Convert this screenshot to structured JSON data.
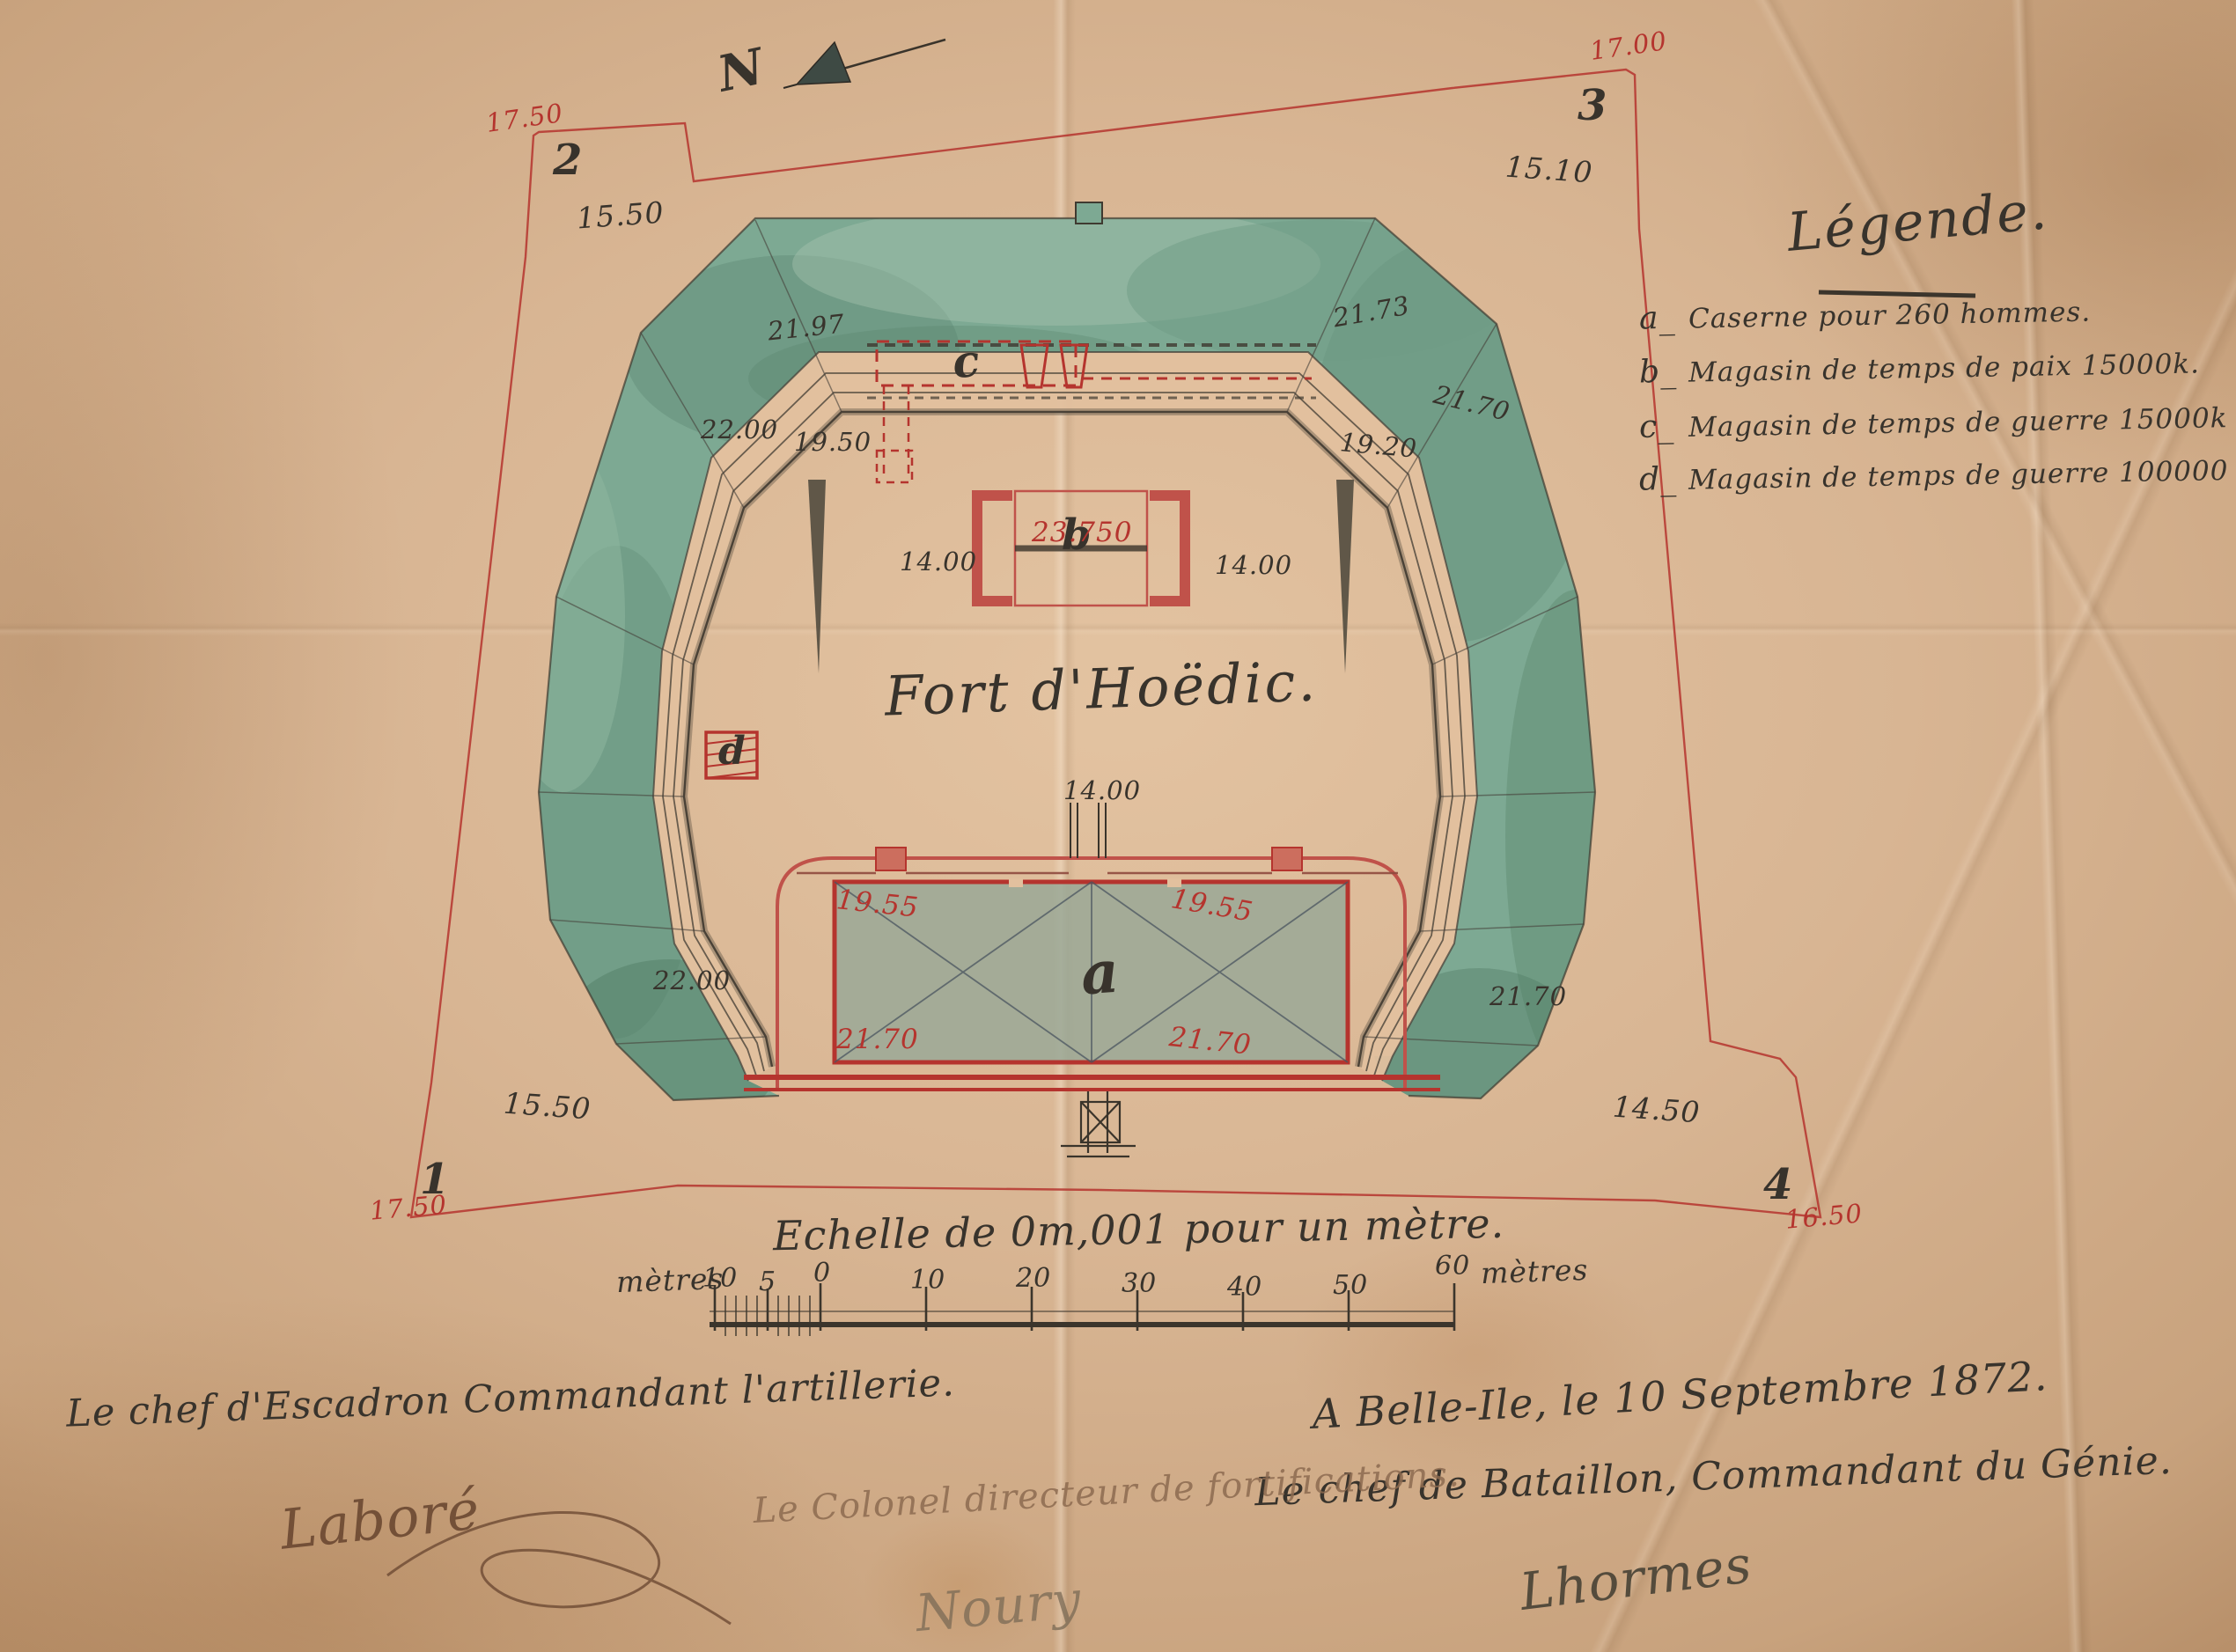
{
  "title": "Fort d'Hoëdic.",
  "north": {
    "label": "N"
  },
  "legend": {
    "header": "Légende.",
    "items": [
      {
        "key": "a_",
        "text": "Caserne pour 260 hommes."
      },
      {
        "key": "b_",
        "text": "Magasin de temps de paix 15000k."
      },
      {
        "key": "c_",
        "text": "Magasin de temps de guerre 15000k"
      },
      {
        "key": "d_",
        "text": "Magasin de temps de guerre 100000 Cartouches."
      }
    ]
  },
  "scale": {
    "caption": "Echelle de 0m,001 pour un mètre.",
    "unit_left": "mètres",
    "unit_right": "mètres",
    "ticks": [
      "10",
      "5",
      "0",
      "10",
      "20",
      "30",
      "40",
      "50",
      "60"
    ]
  },
  "survey_corners": [
    {
      "label": "1"
    },
    {
      "label": "2"
    },
    {
      "label": "3"
    },
    {
      "label": "4"
    }
  ],
  "plan_letters": [
    {
      "char": "a"
    },
    {
      "char": "b"
    },
    {
      "char": "c"
    },
    {
      "char": "d"
    }
  ],
  "measurements": [
    {
      "value": "17.50",
      "color": "red"
    },
    {
      "value": "15.50",
      "color": "black"
    },
    {
      "value": "17.00",
      "color": "red"
    },
    {
      "value": "15.10",
      "color": "black"
    },
    {
      "value": "21.97",
      "color": "black"
    },
    {
      "value": "22.00",
      "color": "black"
    },
    {
      "value": "19.50",
      "color": "black"
    },
    {
      "value": "21.73",
      "color": "black"
    },
    {
      "value": "21.70",
      "color": "black"
    },
    {
      "value": "19.20",
      "color": "black"
    },
    {
      "value": "14.00",
      "color": "black"
    },
    {
      "value": "23.750",
      "color": "red"
    },
    {
      "value": "14.00",
      "color": "black"
    },
    {
      "value": "14.00",
      "color": "black"
    },
    {
      "value": "19.55",
      "color": "red"
    },
    {
      "value": "19.55",
      "color": "red"
    },
    {
      "value": "21.70",
      "color": "red"
    },
    {
      "value": "21.70",
      "color": "red"
    },
    {
      "value": "22.00",
      "color": "black"
    },
    {
      "value": "21.70",
      "color": "black"
    },
    {
      "value": "15.50",
      "color": "black"
    },
    {
      "value": "17.50",
      "color": "red"
    },
    {
      "value": "14.50",
      "color": "black"
    },
    {
      "value": "16.50",
      "color": "red"
    }
  ],
  "footer": {
    "artillery_line": "Le chef d'Escadron Commandant l'artillerie.",
    "place_date": "A Belle-Ile, le 10 Septembre 1872.",
    "engineer_line": "Le chef de Bataillon, Commandant du Génie.",
    "colonel_line": "Le Colonel directeur de fortifications.",
    "signature_left": "Laboré",
    "signature_center": "Noury",
    "signature_right": "Lhormes"
  },
  "colors": {
    "red_ink": "#b5342e",
    "black_ink": "#38332c",
    "faded_ink": "#8d6b50",
    "green_wash": "#7da993",
    "paper": "#d3ae8c"
  }
}
